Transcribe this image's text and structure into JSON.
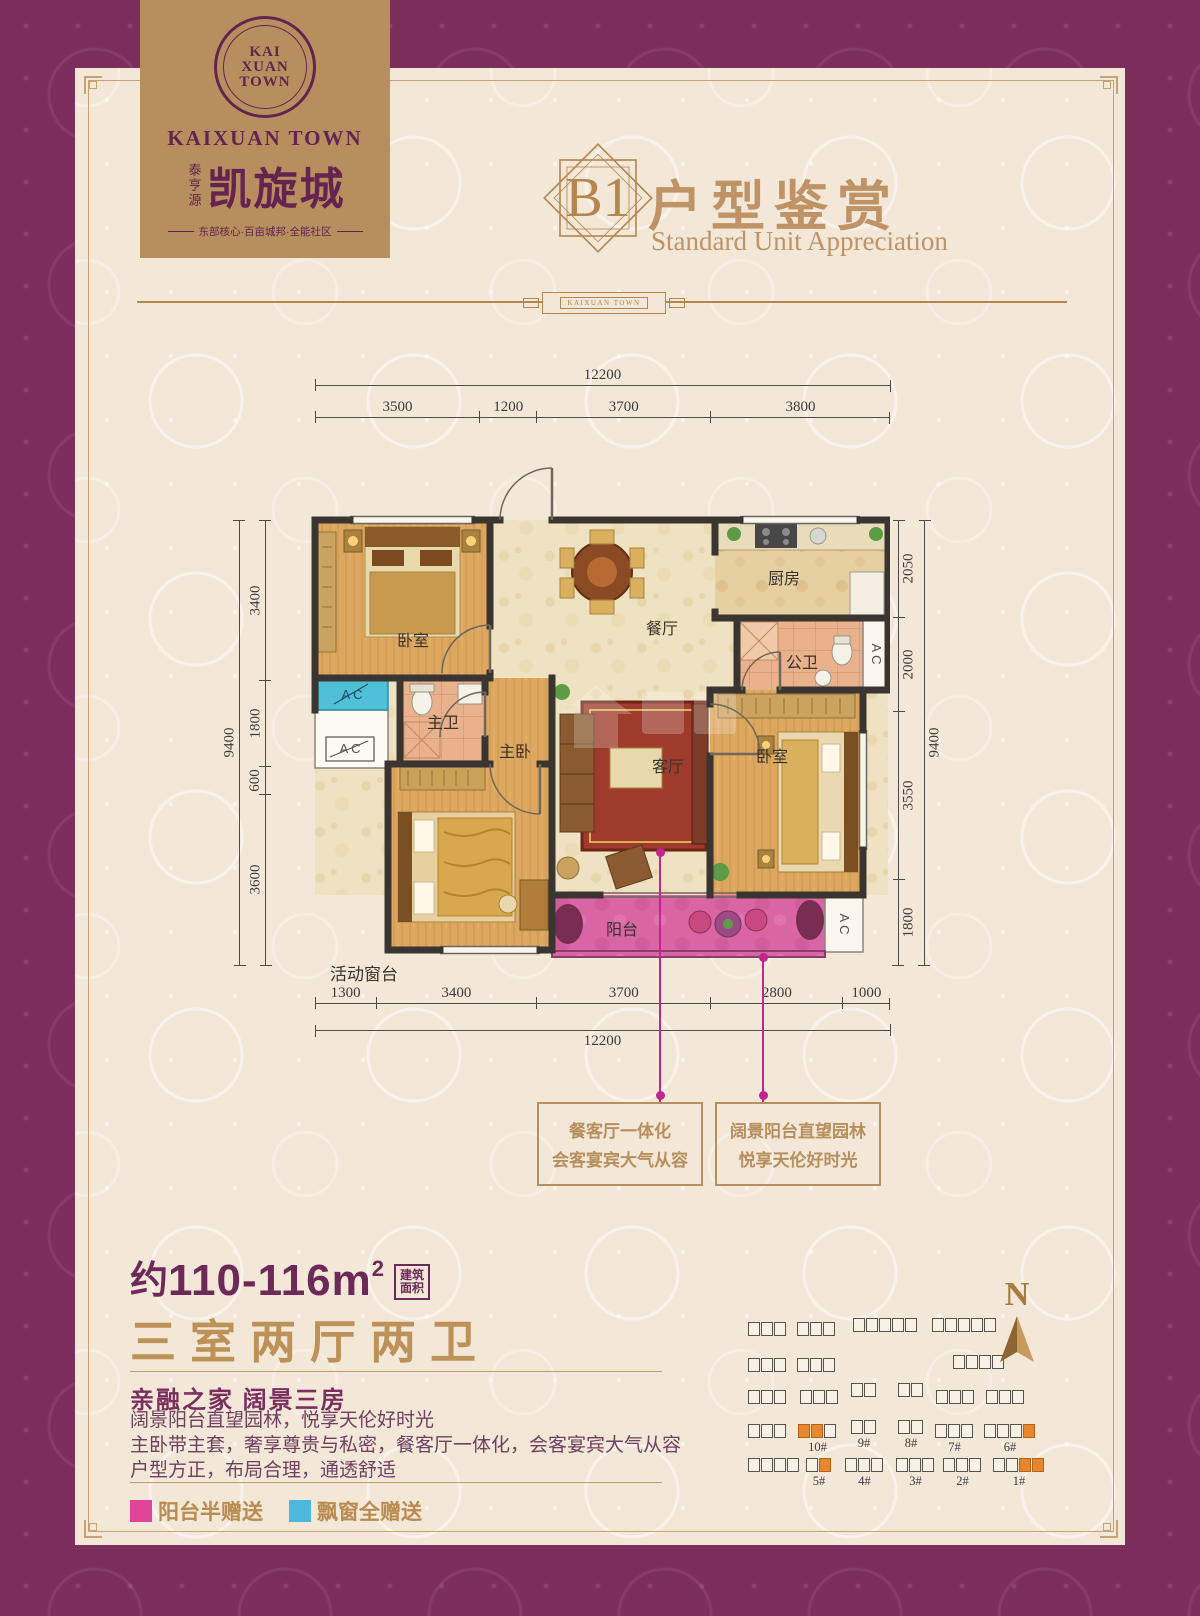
{
  "brand": {
    "monogram": [
      "KAI",
      "XUAN",
      "TOWN"
    ],
    "name_en": "KAIXUAN TOWN",
    "name_prefix_cn": "泰亨源",
    "name_cn": "凯旋城",
    "tagline": "东部核心·百亩城邦·全能社区"
  },
  "header": {
    "unit_code": "B1",
    "title_cn": "户型鉴赏",
    "title_en": "Standard Unit Appreciation",
    "divider_label": "KAIXUAN TOWN"
  },
  "floor_plan": {
    "rooms": {
      "bedroom1": "卧室",
      "dining": "餐厅",
      "kitchen": "厨房",
      "guest_bath": "公卫",
      "master_bath": "主卫",
      "master_bedroom": "主卧",
      "living": "客厅",
      "bedroom2": "卧室",
      "balcony": "阳台"
    },
    "ac": "A C",
    "window_note": "活动窗台",
    "dimensions": {
      "top": {
        "total": [
          "12200"
        ],
        "segments": [
          "3500",
          "1200",
          "3700",
          "3800"
        ]
      },
      "bottom": {
        "total": [
          "12200"
        ],
        "segments": [
          "1300",
          "3400",
          "3700",
          "2800",
          "1000"
        ]
      },
      "left": {
        "total": [
          "9400"
        ],
        "segments": [
          "3400",
          "1800",
          "600",
          "3600"
        ]
      },
      "right": {
        "total": [
          "9400"
        ],
        "segments": [
          "2050",
          "2000",
          "3550",
          "1800"
        ]
      }
    },
    "callouts": [
      {
        "lines": [
          "餐客厅一体化",
          "会客宴宾大气从容"
        ]
      },
      {
        "lines": [
          "阔景阳台直望园林",
          "悦享天伦好时光"
        ]
      }
    ]
  },
  "details": {
    "area_prefix": "约",
    "area_value": "110-116m",
    "area_sup": "2",
    "area_note_top": "建筑",
    "area_note_bottom": "面积",
    "layout_title": "三室两厅两卫",
    "subtitle": "亲融之家  阔景三房",
    "descriptions": [
      "阔景阳台直望园林，悦享天伦好时光",
      "主卧带主套，奢享尊贵与私密，餐客厅一体化，会客宴宾大气从容",
      "户型方正，布局合理，通透舒适"
    ],
    "legend": [
      {
        "color": "#e0459a",
        "label": "阳台半赠送"
      },
      {
        "color": "#4db7e0",
        "label": "飘窗全赠送"
      }
    ]
  },
  "site_plan": {
    "north": "N",
    "buildings": [
      {
        "x": 748,
        "y": 1322,
        "u": 3
      },
      {
        "x": 797,
        "y": 1322,
        "u": 3
      },
      {
        "x": 853,
        "y": 1318,
        "u": 5
      },
      {
        "x": 932,
        "y": 1318,
        "u": 5
      },
      {
        "x": 748,
        "y": 1358,
        "u": 3
      },
      {
        "x": 797,
        "y": 1358,
        "u": 3
      },
      {
        "x": 953,
        "y": 1355,
        "u": 4
      },
      {
        "x": 851,
        "y": 1383,
        "u": 2
      },
      {
        "x": 898,
        "y": 1383,
        "u": 2
      },
      {
        "x": 748,
        "y": 1390,
        "u": 3
      },
      {
        "x": 800,
        "y": 1390,
        "u": 3
      },
      {
        "x": 936,
        "y": 1390,
        "u": 3
      },
      {
        "x": 986,
        "y": 1390,
        "u": 3
      },
      {
        "x": 748,
        "y": 1424,
        "u": 3
      },
      {
        "x": 798,
        "y": 1424,
        "u": 3,
        "o": [
          0,
          1
        ],
        "label": "10#"
      },
      {
        "x": 851,
        "y": 1420,
        "u": 2,
        "label": "9#"
      },
      {
        "x": 898,
        "y": 1420,
        "u": 2,
        "label": "8#"
      },
      {
        "x": 935,
        "y": 1424,
        "u": 3,
        "label": "7#"
      },
      {
        "x": 984,
        "y": 1424,
        "u": 4,
        "o": [
          3
        ],
        "label": "6#"
      },
      {
        "x": 748,
        "y": 1458,
        "u": 4
      },
      {
        "x": 806,
        "y": 1458,
        "u": 2,
        "o": [
          1
        ],
        "label": "5#"
      },
      {
        "x": 845,
        "y": 1458,
        "u": 3,
        "label": "4#"
      },
      {
        "x": 896,
        "y": 1458,
        "u": 3,
        "label": "3#"
      },
      {
        "x": 943,
        "y": 1458,
        "u": 3,
        "label": "2#"
      },
      {
        "x": 993,
        "y": 1458,
        "u": 4,
        "o": [
          2,
          3
        ],
        "label": "1#"
      }
    ]
  },
  "colors": {
    "border_purple": "#7c2e5d",
    "cream": "#f3e7d8",
    "gold_block": "#b78f5e",
    "brand_purple": "#652350",
    "title_gold": "#bf9366",
    "balcony_pink": "#d76da6",
    "legend_pink": "#e0459a",
    "legend_blue": "#4db7e0",
    "callout_magenta": "#c2258c",
    "orange_unit": "#e8862d"
  }
}
